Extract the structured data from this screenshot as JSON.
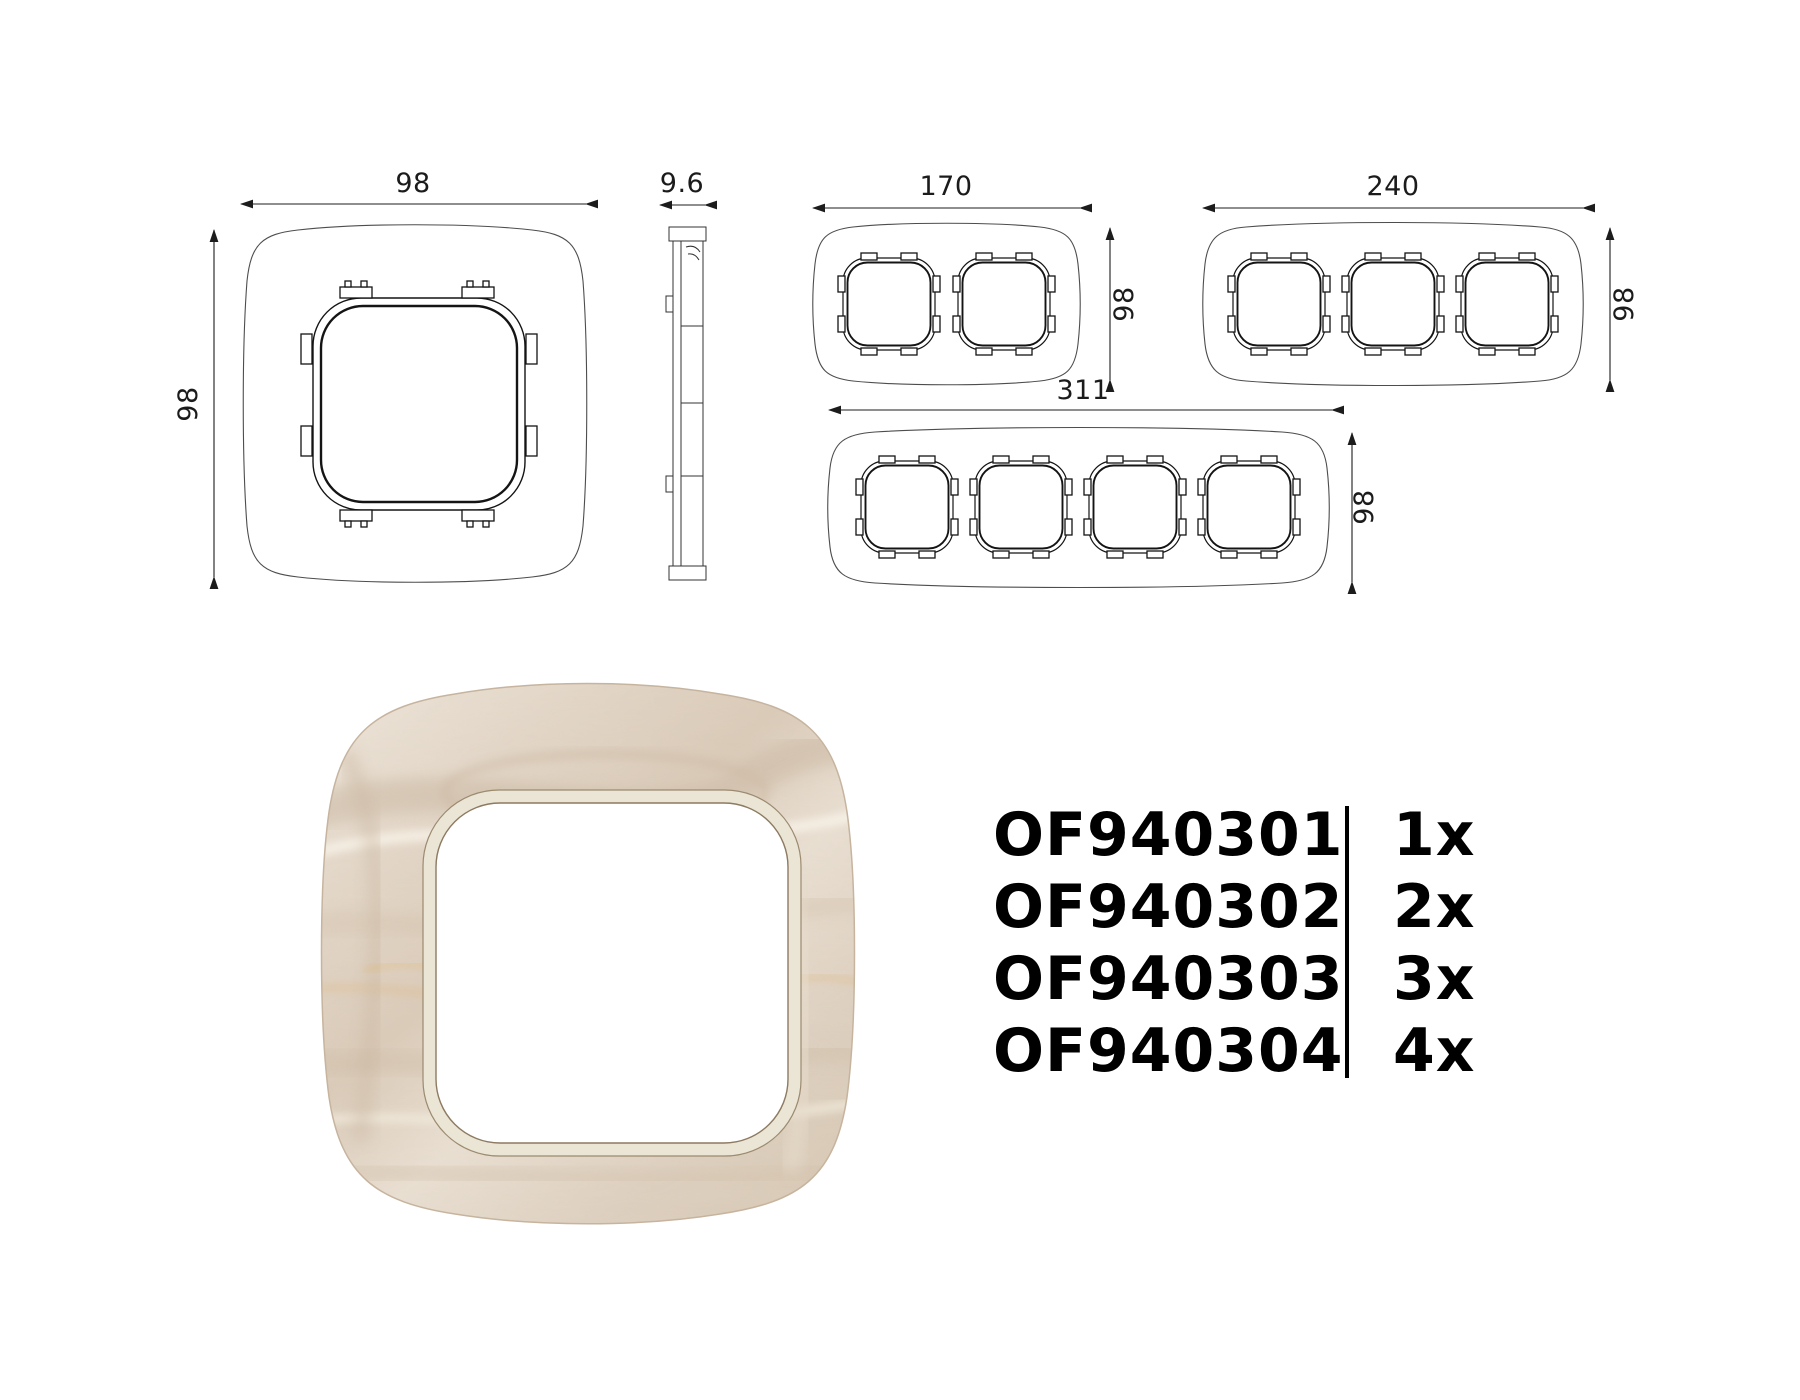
{
  "dimensions": {
    "front_width": "98",
    "front_height": "98",
    "depth": "9.6",
    "two_gang_width": "170",
    "two_gang_height": "98",
    "three_gang_width": "240",
    "three_gang_height": "98",
    "four_gang_width": "311",
    "four_gang_height": "98"
  },
  "parts": {
    "rows": [
      {
        "code": "OF940301",
        "qty": "1x"
      },
      {
        "code": "OF940302",
        "qty": "2x"
      },
      {
        "code": "OF940303",
        "qty": "3x"
      },
      {
        "code": "OF940304",
        "qty": "4x"
      }
    ]
  },
  "colors": {
    "drawing_line": "#1b1b1b",
    "wood_base": "#e7dccf",
    "wood_shadow": "#d2c1ae",
    "wood_highlight": "#f5efe4",
    "wood_gold": "#e0c295",
    "bevel": "#eae5d4",
    "bevel_edge": "#8d7a61",
    "text": "#000000"
  }
}
